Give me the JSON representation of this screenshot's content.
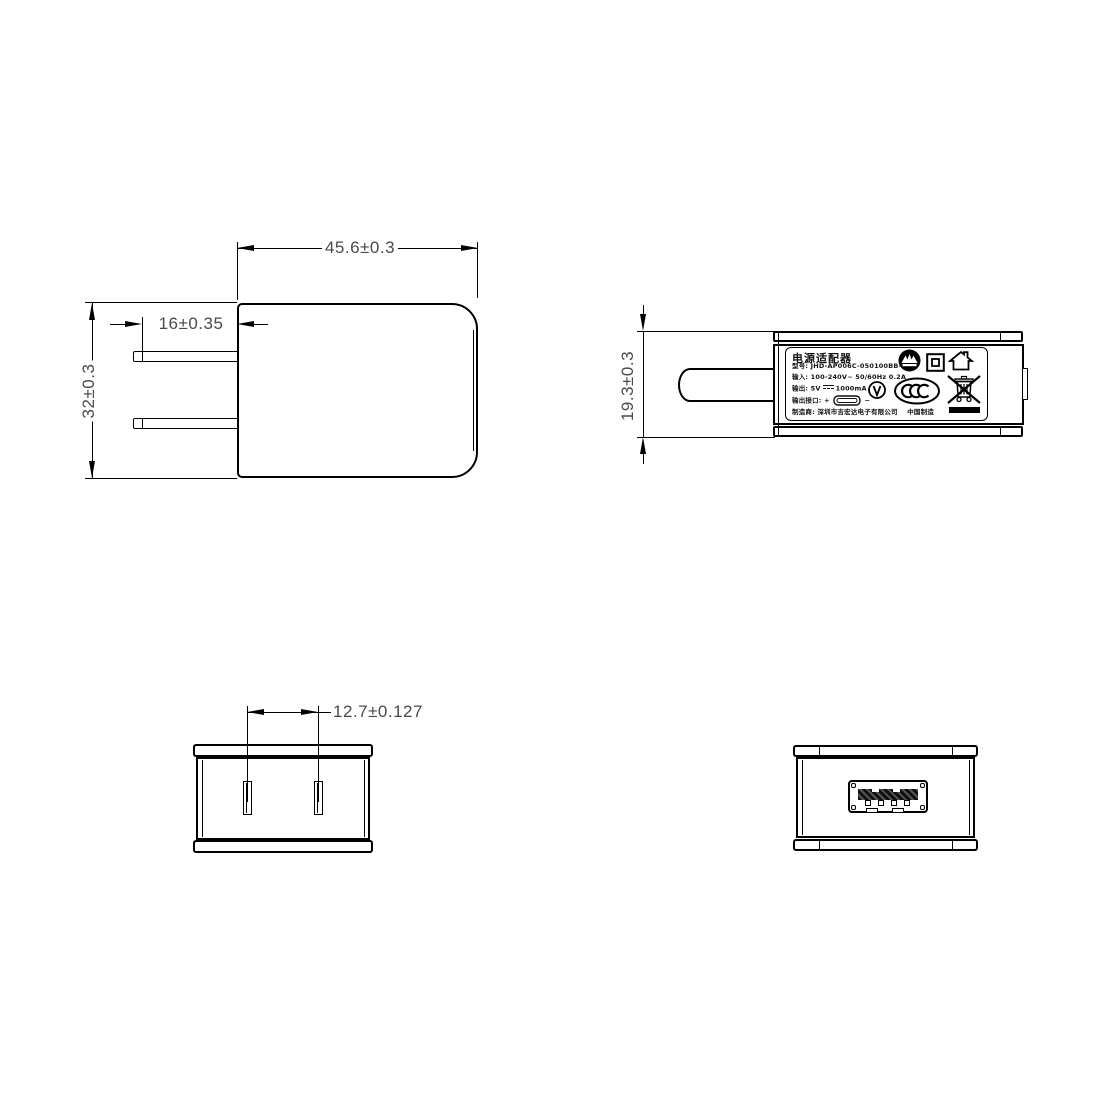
{
  "drawing_type": "power-adapter-technical-drawing",
  "views": {
    "front": {
      "width_dim": "45.6±0.3",
      "pin_length_dim": "16±0.35",
      "height_dim": "32±0.3"
    },
    "side": {
      "thickness_dim": "19.3±0.3"
    },
    "pin_face": {
      "pin_spacing_dim": "12.7±0.127"
    }
  },
  "label": {
    "title": "电源适配器",
    "model": "型号: JHD-AP006C-050100BB-2",
    "input": "输入: 100-240V~  50/60Hz  0.2A",
    "output_prefix": "输出: 5V",
    "output_suffix": "1000mA",
    "port_prefix": "输出接口:",
    "port_plus": "+",
    "port_minus": "−",
    "manufacturer": "制造商: 深圳市吉宏达电子有限公司",
    "made_in": "中国制造",
    "icons": [
      {
        "name": "cqc-scalloped-mark-icon"
      },
      {
        "name": "class-ii-insulation-icon"
      },
      {
        "name": "indoor-use-only-icon"
      },
      {
        "name": "efficiency-level-v-icon"
      },
      {
        "name": "ccc-certification-icon"
      },
      {
        "name": "weee-crossed-bin-icon"
      },
      {
        "name": "black-bar-mark"
      }
    ]
  },
  "colors": {
    "line": "#000000",
    "dim_text": "#4a4a4a",
    "background": "#ffffff"
  }
}
